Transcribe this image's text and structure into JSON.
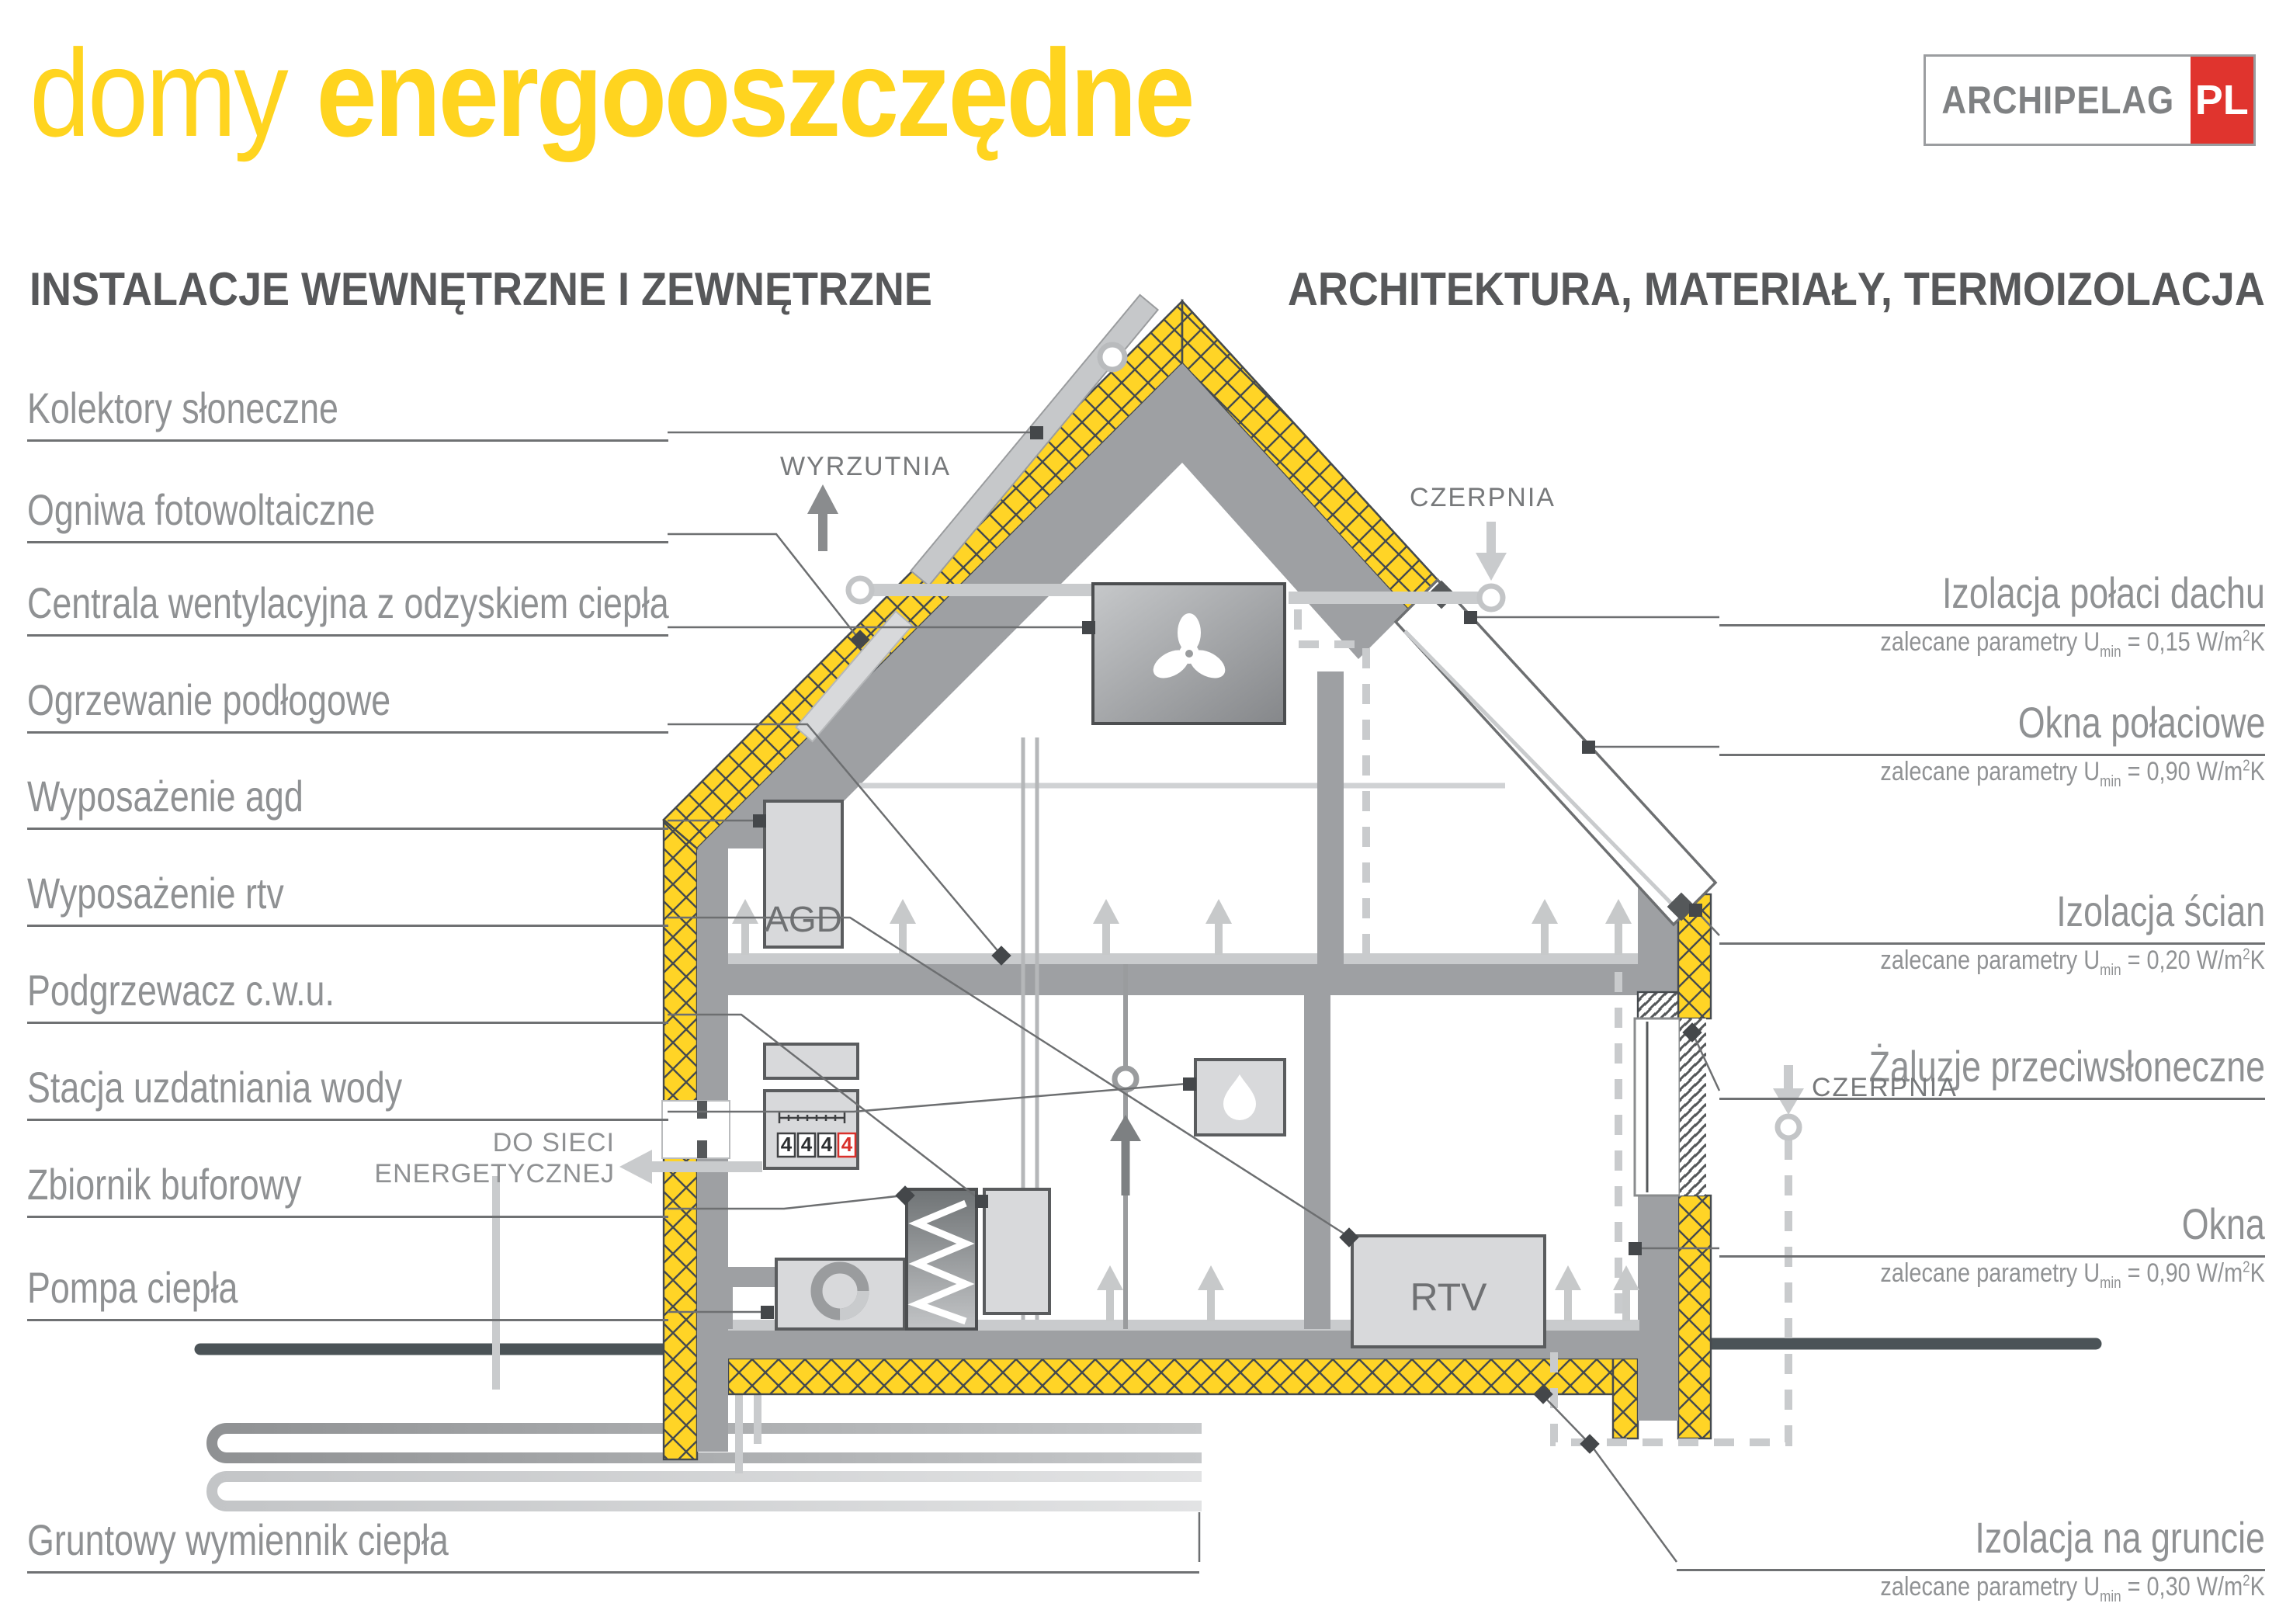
{
  "title": {
    "light": "domy",
    "bold": "energooszczędne"
  },
  "logo": {
    "name": "ARCHIPELAG",
    "tld": "PL"
  },
  "headings": {
    "left": "INSTALACJE WEWNĘTRZNE I ZEWNĘTRZNE",
    "right": "ARCHITEKTURA, MATERIAŁY, TERMOIZOLACJA"
  },
  "left_labels": [
    {
      "text": "Kolektory słoneczne"
    },
    {
      "text": "Ogniwa fotowoltaiczne"
    },
    {
      "text": "Centrala wentylacyjna z odzyskiem ciepła"
    },
    {
      "text": "Ogrzewanie podłogowe"
    },
    {
      "text": "Wyposażenie agd"
    },
    {
      "text": "Wyposażenie rtv"
    },
    {
      "text": "Podgrzewacz c.w.u."
    },
    {
      "text": "Stacja uzdatniania wody"
    },
    {
      "text": "Zbiornik buforowy"
    },
    {
      "text": "Pompa ciepła"
    },
    {
      "text": "Gruntowy wymiennik ciepła"
    }
  ],
  "right_labels": [
    {
      "text": "Izolacja połaci dachu",
      "param": {
        "pre": "zalecane parametry U",
        "sub": "min",
        "eq": " = 0,15 W/m",
        "sup": "2",
        "unit": "K"
      }
    },
    {
      "text": "Okna połaciowe",
      "param": {
        "pre": "zalecane parametry U",
        "sub": "min",
        "eq": " = 0,90 W/m",
        "sup": "2",
        "unit": "K"
      }
    },
    {
      "text": "Izolacja ścian",
      "param": {
        "pre": "zalecane parametry U",
        "sub": "min",
        "eq": " = 0,20 W/m",
        "sup": "2",
        "unit": "K"
      }
    },
    {
      "text": "Żaluzje przeciwsłoneczne"
    },
    {
      "text": "Okna",
      "param": {
        "pre": "zalecane parametry U",
        "sub": "min",
        "eq": " = 0,90 W/m",
        "sup": "2",
        "unit": "K"
      }
    },
    {
      "text": "Izolacja na gruncie",
      "param": {
        "pre": "zalecane parametry U",
        "sub": "min",
        "eq": " = 0,30 W/m",
        "sup": "2",
        "unit": "K"
      }
    }
  ],
  "annotations": {
    "wyrzutnia": "WYRZUTNIA",
    "czerpnia_roof": "CZERPNIA",
    "czerpnia_ground": "CZERPNIA",
    "grid_line1": "DO SIECI",
    "grid_line2": "ENERGETYCZNEJ"
  },
  "equipment": {
    "agd": "AGD",
    "rtv": "RTV",
    "meter_digits": [
      "4",
      "4",
      "4",
      "4"
    ]
  },
  "colors": {
    "accent_yellow": "#FFD41F",
    "insulation_yellow": "#FFD426",
    "logo_red": "#E0342E",
    "meter_red": "#D9302B",
    "wall_gray": "#9EA0A3",
    "heading_gray": "#57585A",
    "label_gray": "#8F9193"
  }
}
